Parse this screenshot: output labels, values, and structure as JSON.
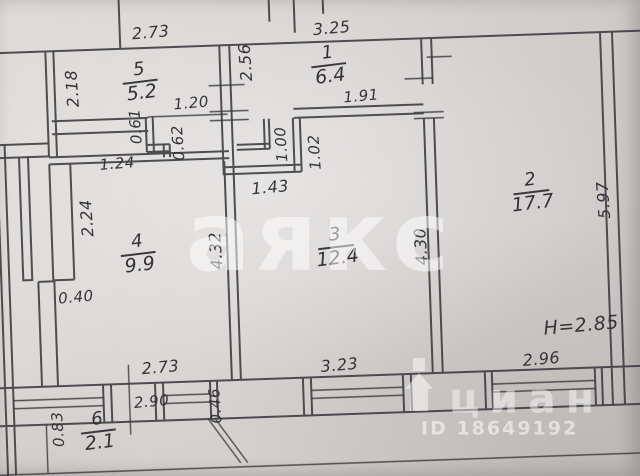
{
  "watermarks": {
    "agency_watermark": "аякс",
    "portal_watermark": "циан",
    "listing_id": "ID 18649192"
  },
  "plan": {
    "ceiling_height": "H=2.85",
    "rooms": [
      {
        "number": "1",
        "area": "6.4"
      },
      {
        "number": "2",
        "area": "17.7"
      },
      {
        "number": "3",
        "area": "12.4"
      },
      {
        "number": "4",
        "area": "9.9"
      },
      {
        "number": "5",
        "area": "5.2"
      },
      {
        "number": "6",
        "area": "2.1"
      }
    ],
    "dims_h": [
      "2.73",
      "3.25",
      "1.20",
      "1.91",
      "1.24",
      "1.43",
      "0.40",
      "2.73",
      "3.23",
      "2.96",
      "2.90"
    ],
    "dims_v": [
      "2.18",
      "2.56",
      "0.61",
      "0.62",
      "1.00",
      "1.02",
      "2.24",
      "4.32",
      "4.30",
      "5.97",
      "0.46",
      "0.83"
    ]
  },
  "colors": {
    "ink": "#3a393f",
    "paper": "#d6d3d1",
    "watermark": "#ffffff"
  }
}
